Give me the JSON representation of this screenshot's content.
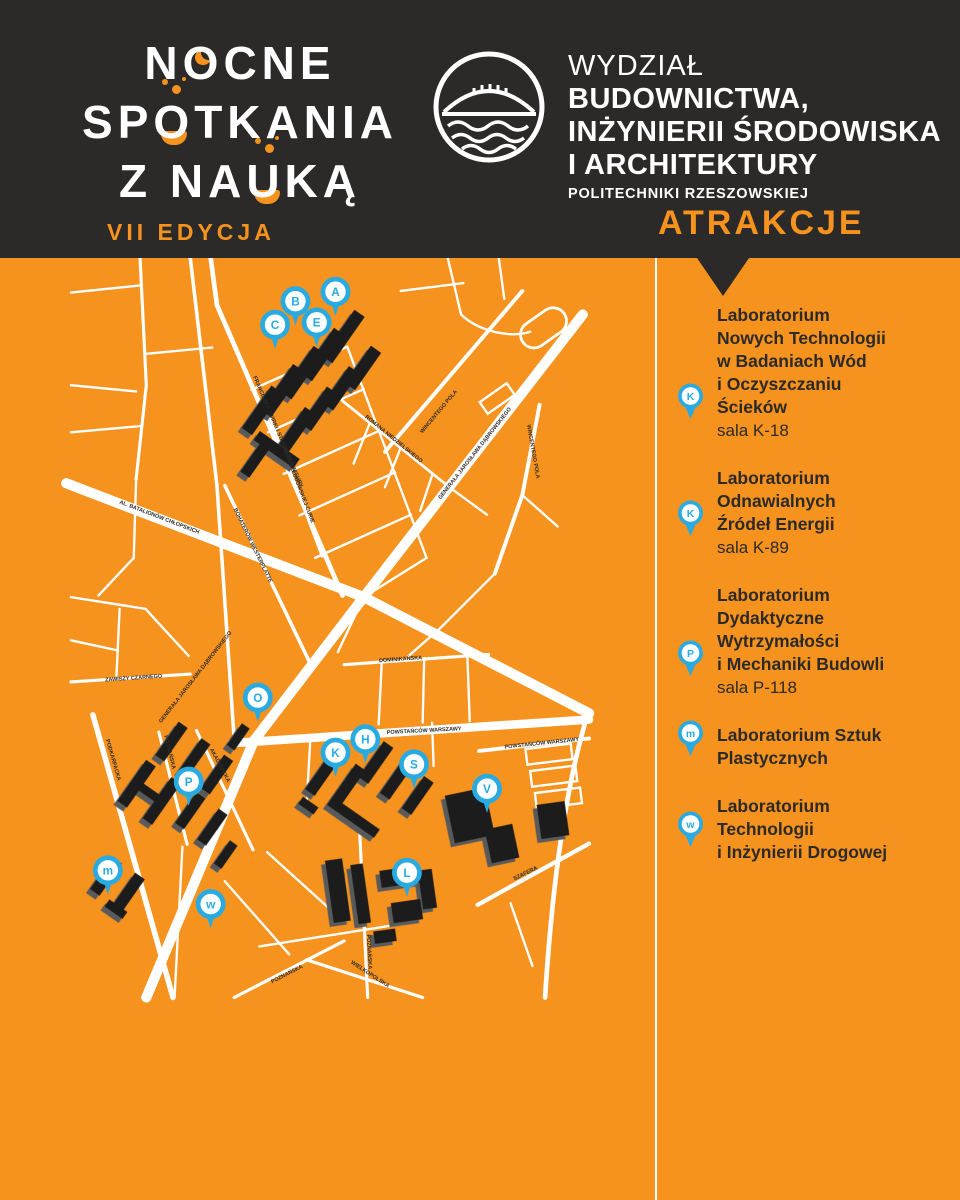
{
  "header": {
    "event_logo": {
      "line1_pre": "N",
      "line1_o": "O",
      "line1_post": "CNE",
      "line2_pre": "SP",
      "line2_o": "O",
      "line2_post": "TKANIA",
      "line3_pre": "Z NA",
      "line3_o": "U",
      "line3_post": "KĄ",
      "edition": "VII EDYCJA"
    },
    "faculty": {
      "line1": "WYDZIAŁ",
      "line2": "BUDOWNICTWA,",
      "line3": "INŻYNIERII ŚRODOWISKA",
      "line4": "I ARCHITEKTURY",
      "line5": "POLITECHNIKI RZESZOWSKIEJ"
    },
    "attractions_title": "ATRAKCJE"
  },
  "sidebar": {
    "items": [
      {
        "pin": "K",
        "title_lines": [
          "Laboratorium",
          "Nowych Technologii",
          "w Badaniach Wód",
          "i Oczyszczaniu",
          "Ścieków"
        ],
        "room": "sala K-18"
      },
      {
        "pin": "K",
        "title_lines": [
          "Laboratorium",
          "Odnawialnych",
          "Źródeł Energii"
        ],
        "room": "sala K-89"
      },
      {
        "pin": "P",
        "title_lines": [
          "Laboratorium",
          "Dydaktyczne",
          "Wytrzymałości",
          "i Mechaniki Budowli"
        ],
        "room": "sala P-118"
      },
      {
        "pin": "m",
        "title_lines": [
          "Laboratorium Sztuk",
          "Plastycznych"
        ],
        "room": ""
      },
      {
        "pin": "w",
        "title_lines": [
          "Laboratorium",
          "Technologii",
          "i Inżynierii Drogowej"
        ],
        "room": ""
      }
    ]
  },
  "map": {
    "markers": [
      "A",
      "B",
      "C",
      "E",
      "O",
      "K",
      "H",
      "S",
      "V",
      "P",
      "m",
      "w",
      "L"
    ],
    "street_labels": [
      "FRANCISZKA ŻWIRKI I STANISŁAWA WIGURY",
      "MARII SKŁODOWSKIEJ-CURIE",
      "ROMANA NIEDZIELSKIEGO",
      "WINCENTEGO POLA",
      "WINCENTEGO POLA",
      "GENERAŁA JAROSŁAWA DĄBROWSKIEGO",
      "GENERAŁA JAROSŁAWA DĄBROWSKIEGO",
      "BOHATERÓW WESTERPLATTE",
      "AL. BATALIONÓW CHŁOPSKICH",
      "ZAWISZY CZARNEGO",
      "DOMINIKAŃSKA",
      "POWSTAŃCÓW WARSZAWY",
      "POWSTAŃCÓW WARSZAWY",
      "PODKARPACKA",
      "POZNAŃSKA",
      "AKADEMICKA",
      "POZNAŃSKA",
      "WIELKOPOLSKA",
      "POZNAŃSKA",
      "SZAFERA"
    ]
  },
  "colors": {
    "background_dark": "#2b2a29",
    "map_orange": "#f6921e",
    "marker_blue": "#29abe2",
    "street_white": "#ffffff",
    "building_black": "#1d1d1b",
    "building_shadow": "#595a5c"
  }
}
